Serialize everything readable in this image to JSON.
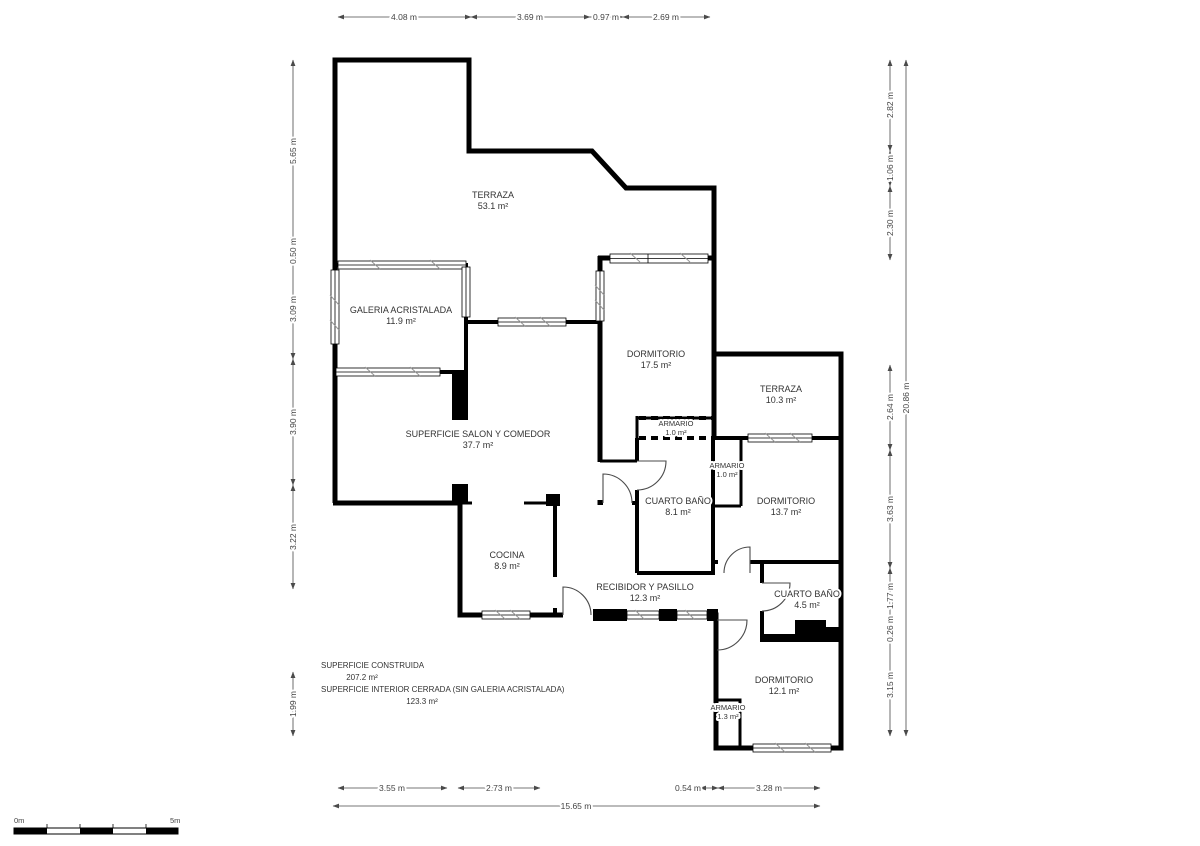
{
  "rooms": [
    {
      "name": "TERRAZA",
      "area": "53.1 m²"
    },
    {
      "name": "GALERIA ACRISTALADA",
      "area": "11.9 m²"
    },
    {
      "name": "DORMITORIO",
      "area": "17.5 m²"
    },
    {
      "name": "TERRAZA",
      "area": "10.3 m²"
    },
    {
      "name": "ARMARIO",
      "area": "1.0 m²"
    },
    {
      "name": "SUPERFICIE SALON Y COMEDOR",
      "area": "37.7 m²"
    },
    {
      "name": "ARMARIO",
      "area": "1.0 m²"
    },
    {
      "name": "CUARTO BAÑO",
      "area": "8.1 m²"
    },
    {
      "name": "DORMITORIO",
      "area": "13.7 m²"
    },
    {
      "name": "COCINA",
      "area": "8.9 m²"
    },
    {
      "name": "RECIBIDOR Y PASILLO",
      "area": "12.3 m²"
    },
    {
      "name": "CUARTO BAÑO",
      "area": "4.5 m²"
    },
    {
      "name": "DORMITORIO",
      "area": "12.1 m²"
    },
    {
      "name": "ARMARIO",
      "area": "1.3 m²"
    }
  ],
  "dims": {
    "top": [
      "4.08 m",
      "3.69 m",
      "0.97 m",
      "2.69 m"
    ],
    "left": [
      "5.65 m",
      "0.50 m",
      "3.09 m",
      "3.90 m",
      "3.22 m",
      "1.99 m"
    ],
    "right": [
      "2.82 m",
      "1.06 m",
      "2.30 m",
      "2.64 m",
      "3.63 m",
      "1.77 m",
      "0.26 m",
      "3.15 m"
    ],
    "right_total": "20.86 m",
    "bottom": [
      "3.55 m",
      "2.73 m",
      "0.54 m",
      "3.28 m"
    ],
    "bottom_total": "15.65 m"
  },
  "summary": {
    "construida_label": "SUPERFICIE CONSTRUIDA",
    "construida_value": "207.2 m²",
    "interior_label": "SUPERFICIE INTERIOR CERRADA (SIN GALERIA ACRISTALADA)",
    "interior_value": "123.3 m²"
  },
  "scale_bar": {
    "start": "0m",
    "end": "5m"
  }
}
